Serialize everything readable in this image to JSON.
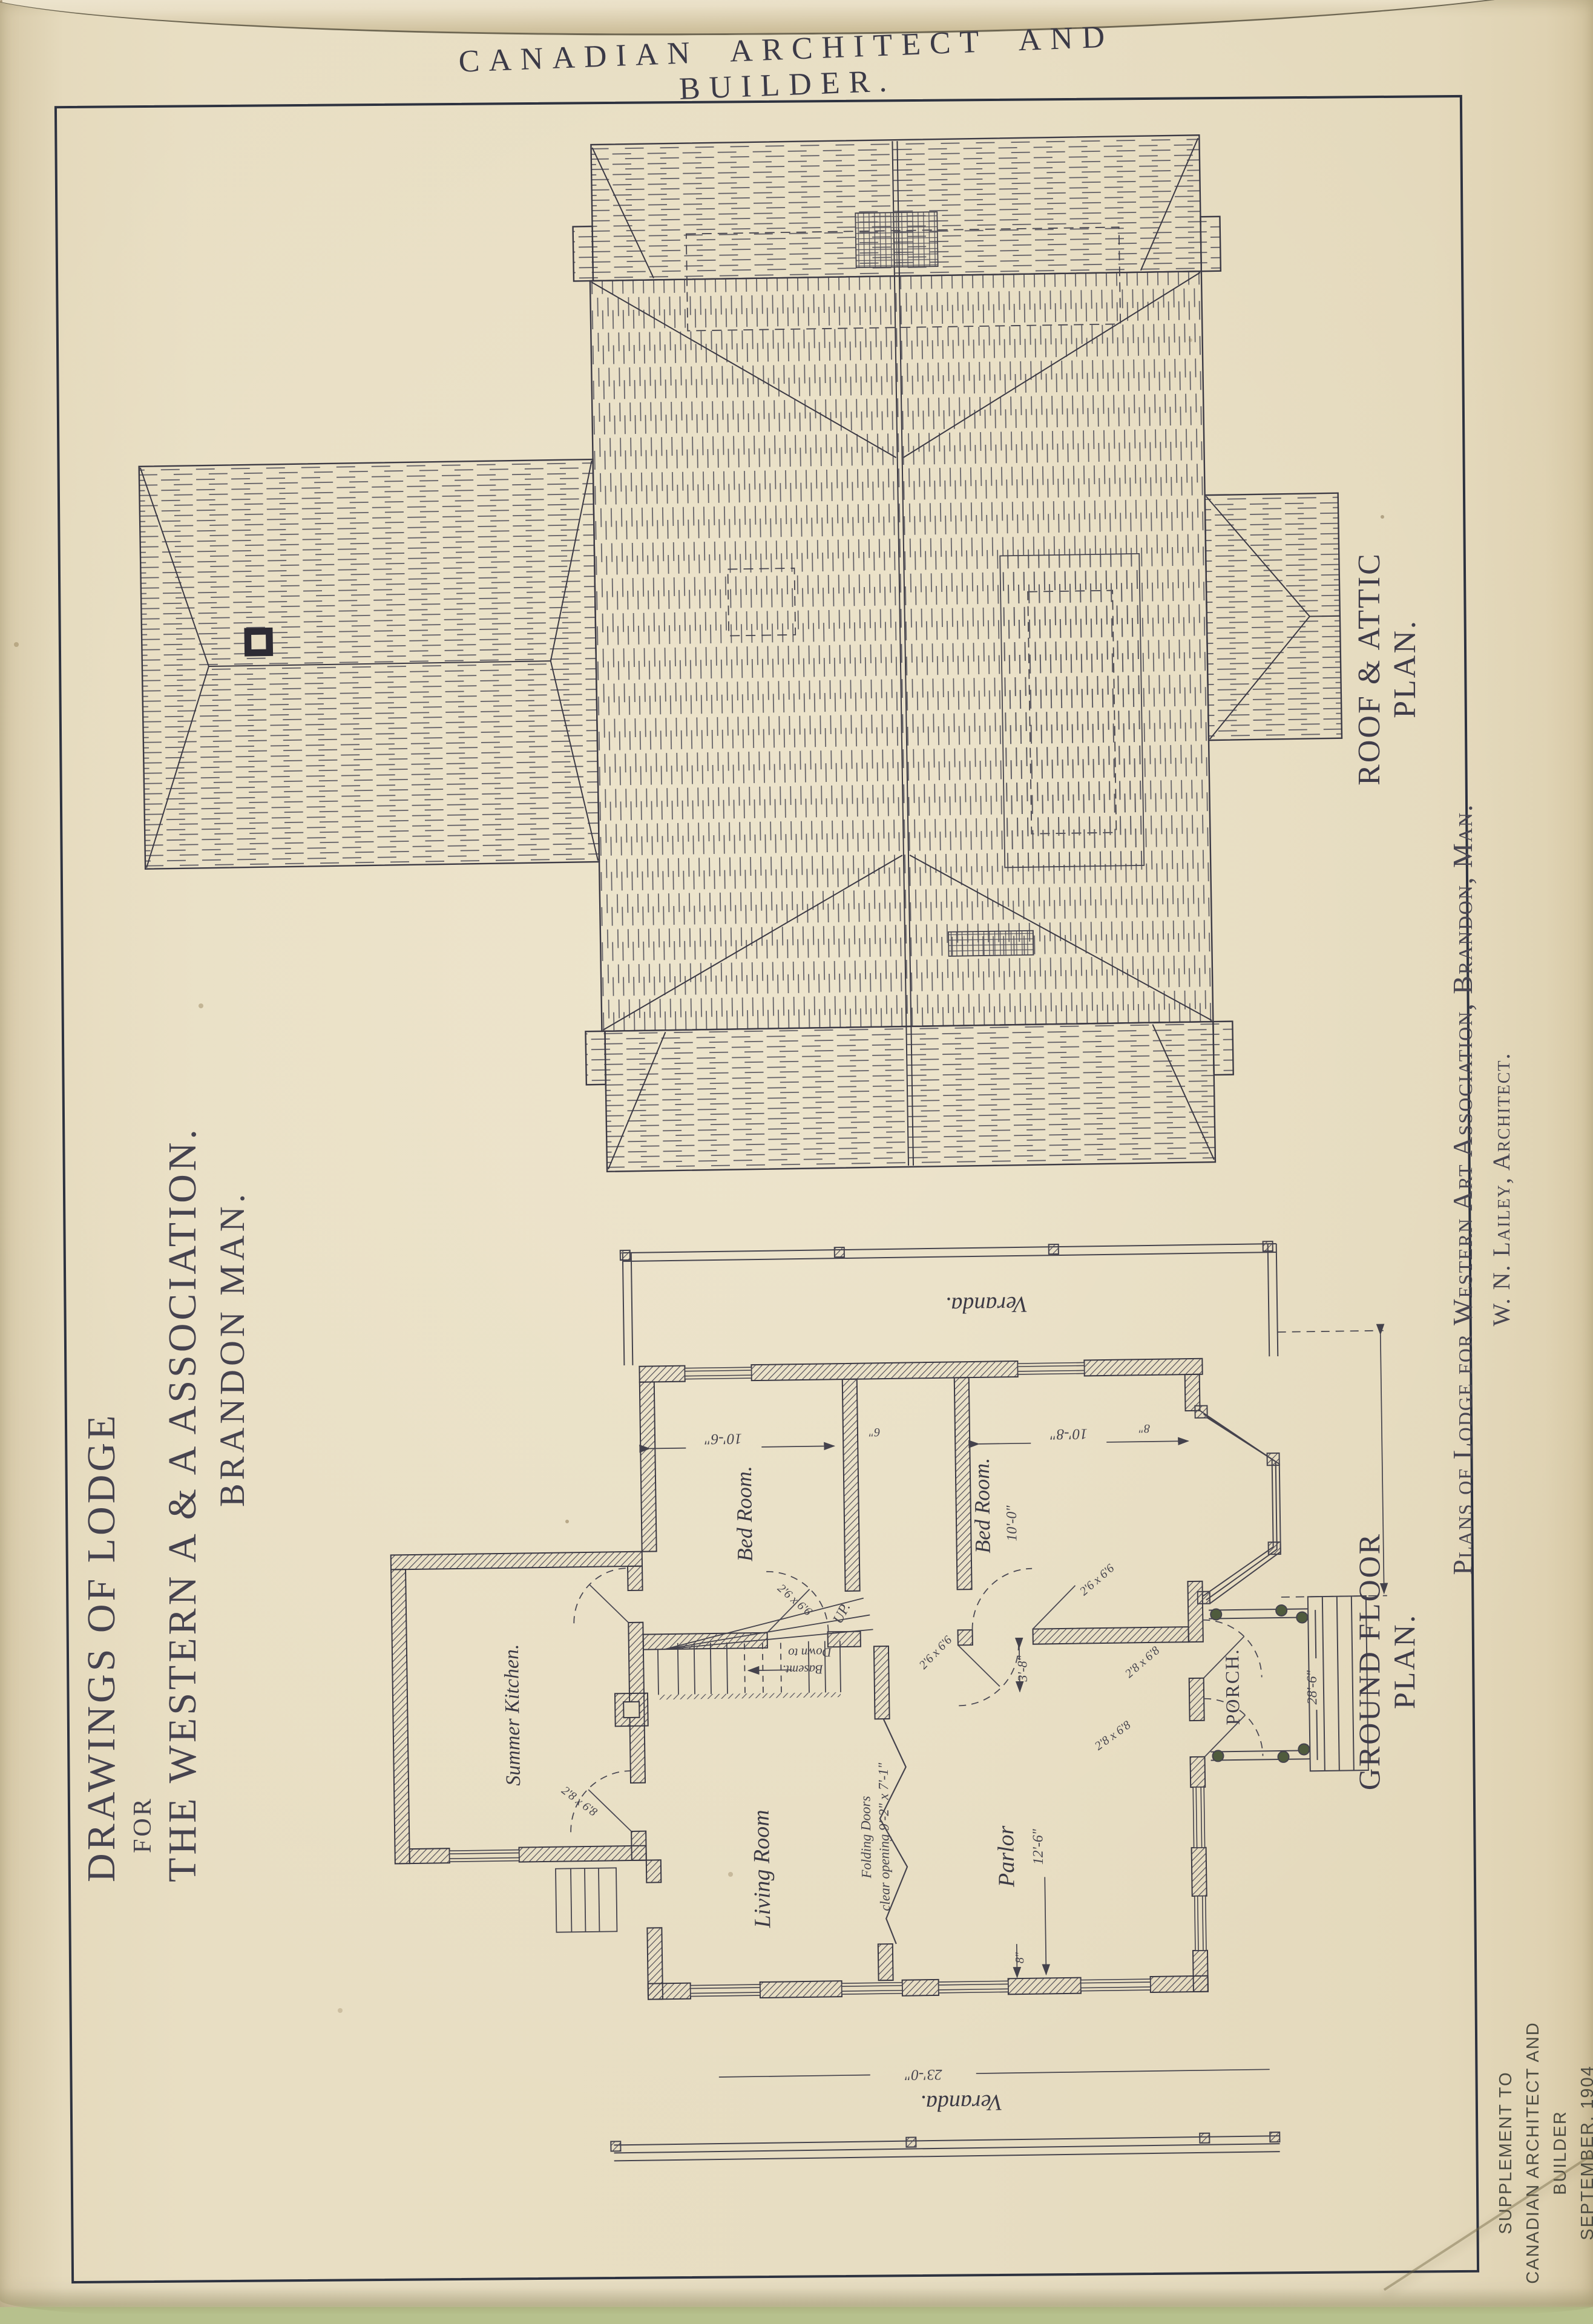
{
  "header": {
    "title": "CANADIAN  ARCHITECT  AND  BUILDER."
  },
  "title_block": {
    "line1": "DRAWINGS OF LODGE",
    "line2": "FOR",
    "line3": "THE WESTERN A & A ASSOCIATION.",
    "line4": "BRANDON MAN."
  },
  "captions": {
    "roof_plan": "ROOF & ATTIC PLAN.",
    "ground_floor_plan": "GROUND FLOOR PLAN.",
    "plate_caption": "Plans of Lodge for Western Art Association, Brandon, Man.",
    "architect": "W. N. Lailey, Architect."
  },
  "imprint": {
    "line1": "SUPPLEMENT TO",
    "line2": "CANADIAN ARCHITECT AND BUILDER",
    "line3": "SEPTEMBER, 1904"
  },
  "plan": {
    "rooms": {
      "veranda_top": "Veranda.",
      "veranda_bottom": "Veranda.",
      "bed_room_left": "Bed Room.",
      "bed_room_right": "Bed Room.",
      "summer_kitchen": "Summer Kitchen.",
      "living_room": "Living Room",
      "parlor": "Parlor",
      "porch": "PORCH."
    },
    "stairs": {
      "up": "UP.",
      "down_line1": "Down to",
      "down_line2": "Basemt."
    },
    "folding": {
      "line1": "Folding Doors",
      "line2": "clear opening 9'-2\" x 7'-1\""
    },
    "dims": {
      "bed_left": "10'-6\"",
      "bed_right": "10'-8\"",
      "bed_right_depth": "10'-0\"",
      "hall": "3'-8\"",
      "parlor": "12'-6\"",
      "veranda": "23'-0\"",
      "porch_steps": "28'-6\"",
      "wall_thick": "8\"",
      "wall_six": "6\""
    },
    "doors": {
      "small": "2'6 x 6'6",
      "large": "2'8 x 6'8"
    }
  },
  "colors": {
    "paper": "#e7ddc2",
    "ink": "#35333d",
    "hatch": "#5c5a62",
    "scanner_background": "#b7c18d",
    "porch_post": "#4f5b3d"
  }
}
